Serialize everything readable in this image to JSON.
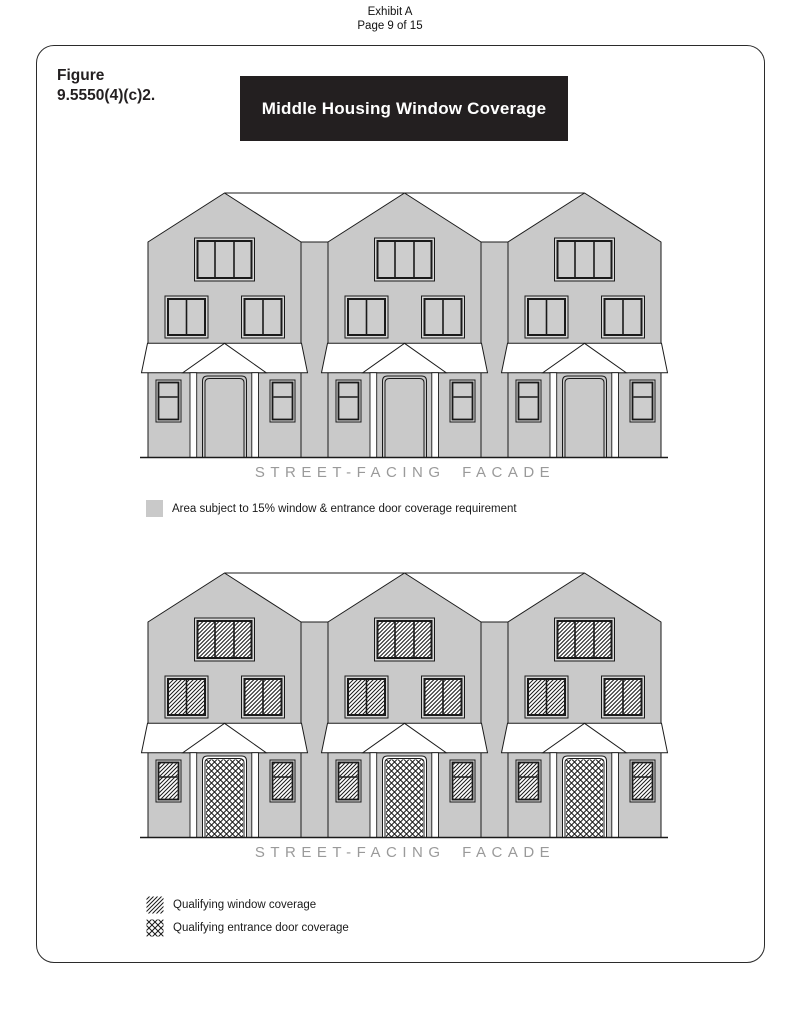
{
  "header": {
    "line1": "Exhibit A",
    "line2": "Page 9 of 15"
  },
  "figure": {
    "label_line1": "Figure",
    "label_line2": "9.5550(4)(c)2.",
    "banner_title": "Middle Housing Window Coverage"
  },
  "diagram_top": {
    "caption": "STREET-FACING FACADE",
    "legend": [
      {
        "swatch": "gray-fill-square",
        "label": "Area subject to 15% window & entrance door coverage requirement"
      }
    ]
  },
  "diagram_bottom": {
    "caption": "STREET-FACING FACADE",
    "legend": [
      {
        "swatch": "diagonal-hatch-square",
        "label": "Qualifying window coverage"
      },
      {
        "swatch": "cross-hatch-square",
        "label": "Qualifying entrance door coverage"
      }
    ]
  },
  "colors": {
    "facade_gray": "#c9c9c9",
    "window_frame_gap": "#d8d8d8",
    "banner_black": "#231f20",
    "banner_text": "#ffffff",
    "caption_gray": "#9a9a9a",
    "line_black": "#1a1a1a"
  }
}
